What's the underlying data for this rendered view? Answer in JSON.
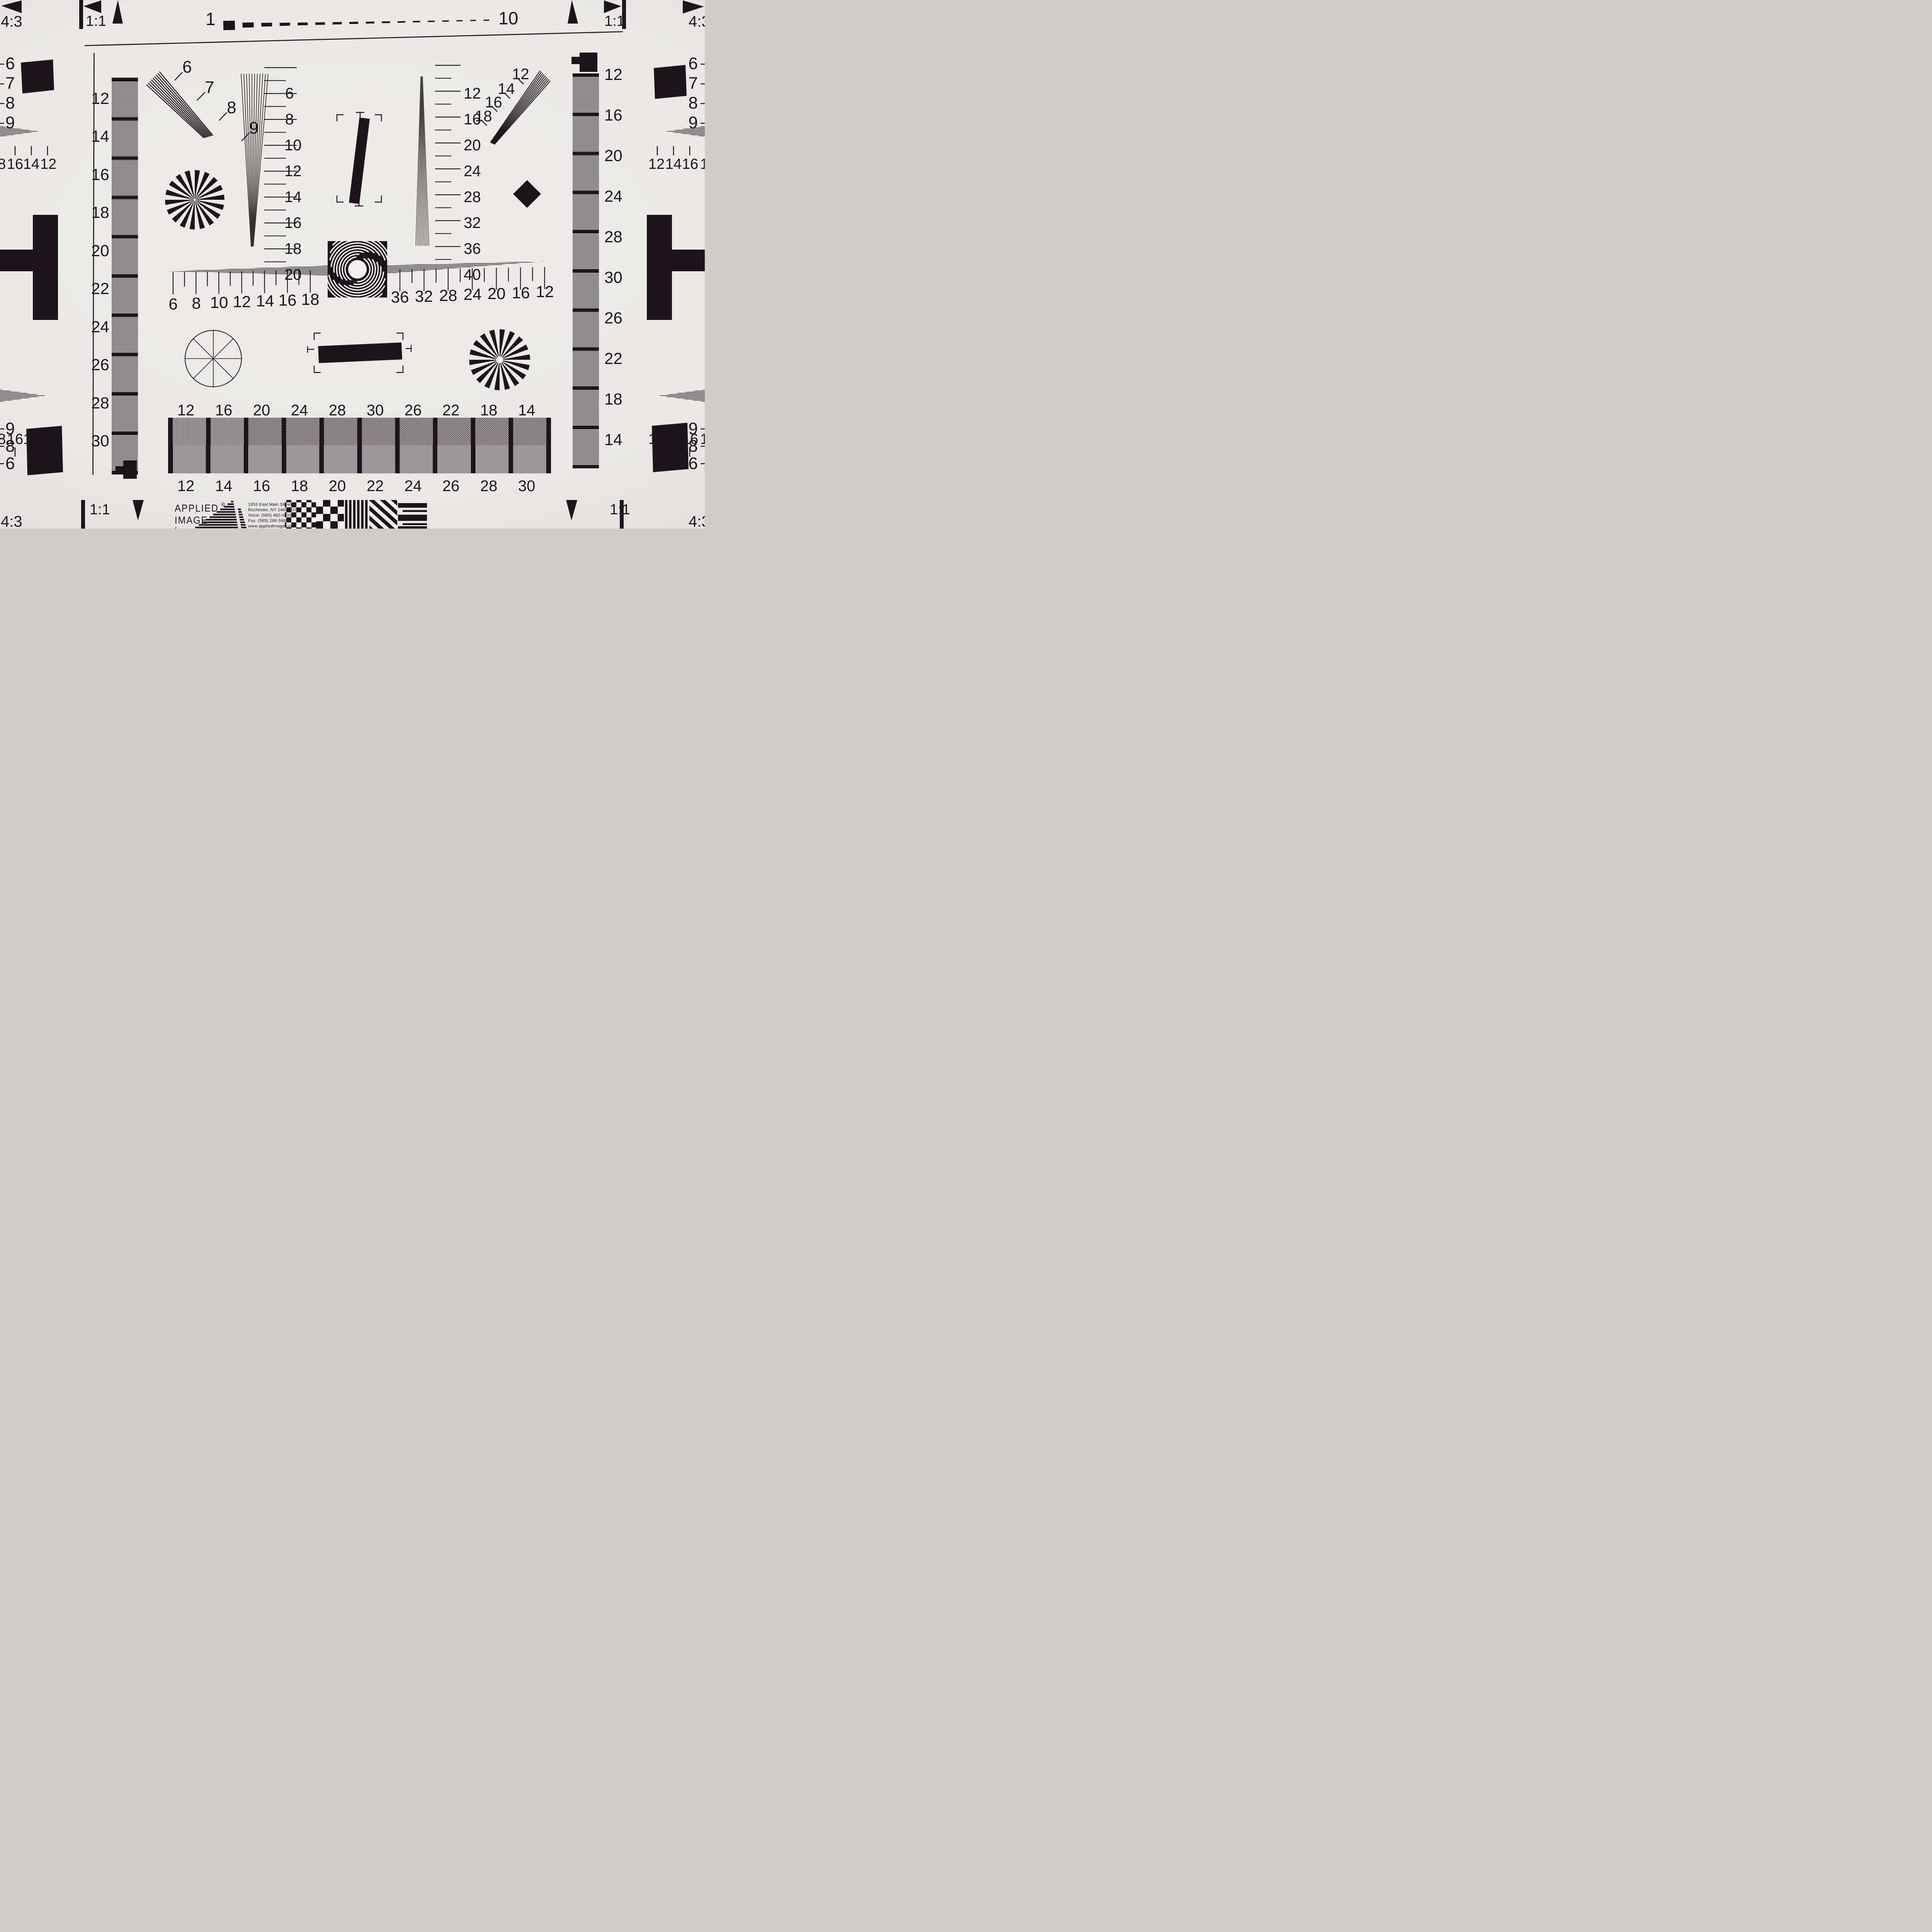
{
  "colors": {
    "background": "#e9e8e6",
    "ink": "#1d151c",
    "paper": "#f1efee"
  },
  "top_edge": {
    "left_ratio": "4:3",
    "left_square": "1:1",
    "scale_start": "1",
    "scale_end": "10",
    "dash_count": 17,
    "right_square": "1:1",
    "right_ratio": "4:3"
  },
  "bottom_edge": {
    "left_ratio": "4:3",
    "left_square": "1:1",
    "right_square": "1:1",
    "right_ratio": "4:3"
  },
  "left_column": {
    "hyperbola_labels": [
      "6",
      "7",
      "8",
      "9"
    ],
    "freq_row_top": [
      "8",
      "16",
      "14",
      "12"
    ],
    "freq_row_bottom": [
      "8",
      "16",
      "14",
      "12"
    ],
    "hyperbola_labels_bottom": [
      "9",
      "8",
      "6"
    ]
  },
  "right_column": {
    "hyperbola_labels": [
      "6",
      "7",
      "8",
      "9"
    ],
    "freq_row_top": [
      "12",
      "14",
      "16",
      "1"
    ],
    "freq_row_bottom": [
      "12",
      "14",
      "16",
      "1"
    ],
    "hyperbola_labels_bottom": [
      "9",
      "8",
      "6"
    ]
  },
  "left_strip_labels": [
    "12",
    "14",
    "16",
    "18",
    "20",
    "22",
    "24",
    "26",
    "28",
    "30"
  ],
  "right_strip_labels": [
    "12",
    "16",
    "20",
    "24",
    "28",
    "30",
    "26",
    "22",
    "18",
    "14"
  ],
  "nw_fan_labels": [
    "6",
    "7",
    "8",
    "9"
  ],
  "ne_fan_labels": [
    "12",
    "14",
    "16",
    "18"
  ],
  "center_v_scale_labels": [
    "6",
    "8",
    "10",
    "12",
    "14",
    "16",
    "18",
    "20"
  ],
  "right_v_scale_labels": [
    "12",
    "16",
    "20",
    "24",
    "28",
    "32",
    "36",
    "40"
  ],
  "h_scale_left_labels": [
    "6",
    "8",
    "10",
    "12",
    "14",
    "16",
    "18"
  ],
  "h_scale_right_labels": [
    "36",
    "32",
    "28",
    "24",
    "20",
    "16",
    "12"
  ],
  "bottom_bar_top_labels": [
    "12",
    "16",
    "20",
    "24",
    "28",
    "30",
    "26",
    "22",
    "18",
    "14"
  ],
  "bottom_bar_bottom_labels": [
    "12",
    "14",
    "16",
    "18",
    "20",
    "22",
    "24",
    "26",
    "28",
    "30"
  ],
  "logo": {
    "brand_line1": "APPLIED",
    "brand_reg": "®",
    "brand_line2": "IMAGE",
    "brand_line3": "Inc",
    "address_line1": "1653 East Main Street",
    "address_line2": "Rochester, NY  14609  USA",
    "address_line3": "Voice:   (585) 482-0300",
    "address_line4": "Fax:      (585) 288-5989",
    "address_line5": "www.appliedimage.com"
  }
}
